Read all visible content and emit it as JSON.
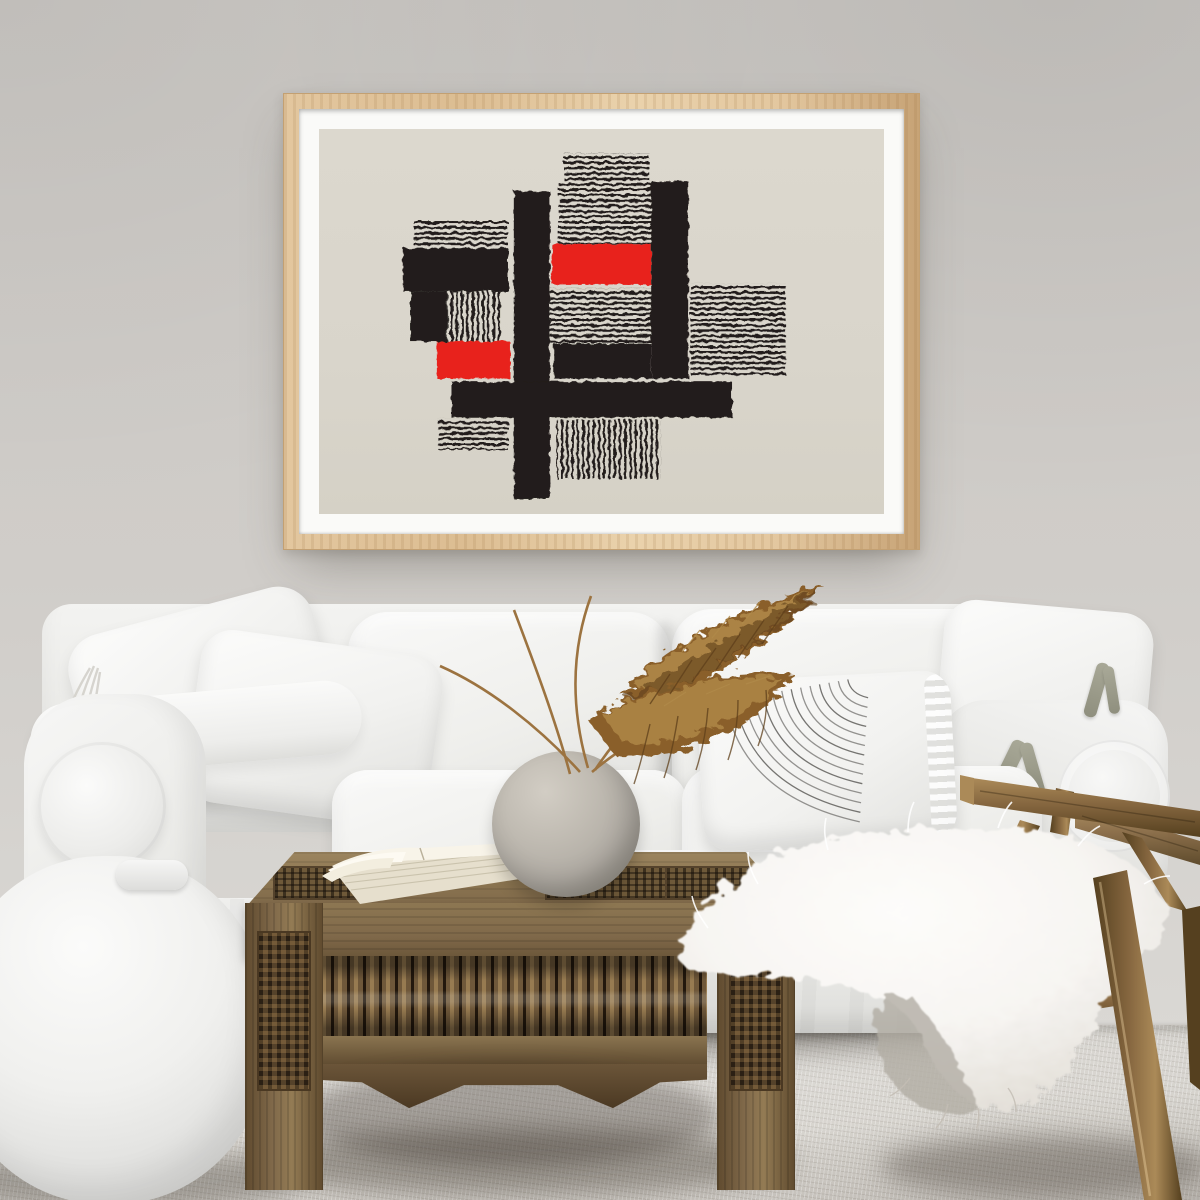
{
  "scene": {
    "setting": "bright living room",
    "objects": [
      "framed abstract poster",
      "white slipcover sofa",
      "white throw pillows",
      "pin-striped lumbar pillow",
      "pillow with fabric ties",
      "white pouf",
      "carved wood coffee table",
      "open book",
      "round stone vase",
      "dried pampas grass",
      "wooden lounge chair",
      "white sheepskin throw",
      "pale gray carpet"
    ]
  },
  "palette": {
    "wall": "#cbc8c4",
    "wall_light": "#dad8d4",
    "carpet": "#d2cfc9",
    "carpet_dark": "#b7b3ac",
    "sofa": "#f5f5f3",
    "sofa_mid": "#e4e4e1",
    "sofa_deep": "#d3d3d0",
    "frame_wood": "#e3c79f",
    "frame_wood_dark": "#c7a376",
    "mat": "#fafaf8",
    "paper": "#d9d5cb",
    "ink": "#211e1a",
    "accent_red": "#e8221a",
    "table_wood": "#80694a",
    "table_wood_dark": "#3b2e1e",
    "table_wood_light": "#9c855f",
    "chair_wood": "#85663f",
    "chair_wood_dark": "#55401f",
    "chair_wood_light": "#ab8a58",
    "pampas": "#8a5f29",
    "pampas_light": "#b08a4a",
    "pampas_dark": "#5e3f1a",
    "vase": "#b1aca4",
    "vase_dark": "#8e897f",
    "fur": "#f7f5f2",
    "fur_gray": "#b2aca4",
    "book_page": "#efe9da",
    "tie_green": "#a8a897"
  },
  "artwork": {
    "frame": {
      "x": 283,
      "y": 93,
      "width": 637,
      "height": 457
    },
    "paper_view": {
      "w": 580,
      "h": 384
    },
    "blocks": [
      {
        "x": 251,
        "y": 24,
        "w": 88,
        "h": 28,
        "t": "hlines"
      },
      {
        "x": 246,
        "y": 52,
        "w": 96,
        "h": 63,
        "t": "hlines"
      },
      {
        "x": 97,
        "y": 90,
        "w": 97,
        "h": 29,
        "t": "hlines"
      },
      {
        "x": 86,
        "y": 119,
        "w": 108,
        "h": 43,
        "t": "black"
      },
      {
        "x": 94,
        "y": 162,
        "w": 37,
        "h": 50,
        "t": "black"
      },
      {
        "x": 131,
        "y": 162,
        "w": 55,
        "h": 50,
        "t": "vlines"
      },
      {
        "x": 121,
        "y": 212,
        "w": 75,
        "h": 37,
        "t": "red"
      },
      {
        "x": 122,
        "y": 289,
        "w": 72,
        "h": 31,
        "t": "hlines"
      },
      {
        "x": 200,
        "y": 62,
        "w": 37,
        "h": 307,
        "t": "black"
      },
      {
        "x": 239,
        "y": 115,
        "w": 102,
        "h": 40,
        "t": "red"
      },
      {
        "x": 237,
        "y": 159,
        "w": 105,
        "h": 55,
        "t": "hlines"
      },
      {
        "x": 241,
        "y": 214,
        "w": 100,
        "h": 35,
        "t": "black"
      },
      {
        "x": 341,
        "y": 52,
        "w": 38,
        "h": 197,
        "t": "black"
      },
      {
        "x": 381,
        "y": 154,
        "w": 98,
        "h": 91,
        "t": "hlines"
      },
      {
        "x": 136,
        "y": 252,
        "w": 288,
        "h": 36,
        "t": "black"
      },
      {
        "x": 244,
        "y": 290,
        "w": 107,
        "h": 59,
        "t": "vlines"
      }
    ]
  },
  "striped_pillow": {
    "cx": 174,
    "cy": 2,
    "r0": 22,
    "dr": 9.5,
    "count": 14,
    "stroke": "#5f5e5a"
  }
}
